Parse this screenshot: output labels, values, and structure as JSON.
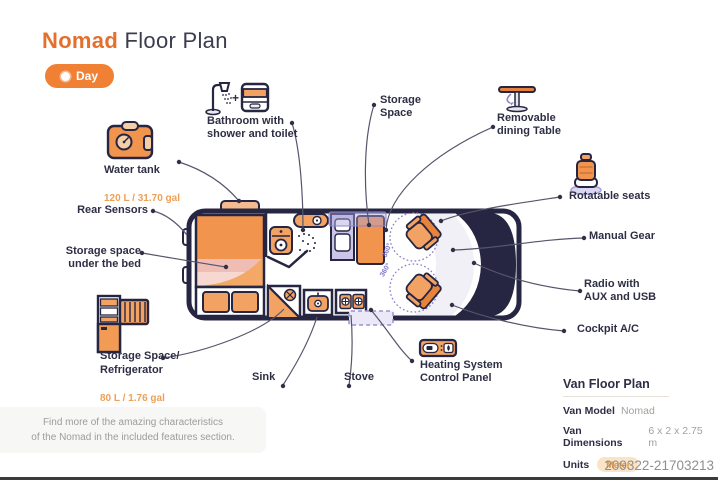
{
  "header": {
    "title_accent": "Nomad",
    "title_rest": "Floor Plan",
    "day_button": "Day"
  },
  "callouts": {
    "bathroom": {
      "label": "Bathroom with\nshower and toilet",
      "plus": "+"
    },
    "storage_space": {
      "label": "Storage\nSpace"
    },
    "dining_table": {
      "label": "Removable\ndining Table"
    },
    "water_tank": {
      "label": "Water tank",
      "value": "120 L / 31.70 gal"
    },
    "rear_sensors": {
      "label": "Rear Sensors"
    },
    "under_bed": {
      "label": "Storage space\nunder the bed"
    },
    "fridge": {
      "label": "Storage Space/\nRefrigerator",
      "value": "80 L / 1.76 gal"
    },
    "sink": {
      "label": "Sink"
    },
    "stove": {
      "label": "Stove"
    },
    "heating": {
      "label": "Heating System\nControl Panel"
    },
    "rotatable_seats": {
      "label": "Rotatable seats"
    },
    "manual_gear": {
      "label": "Manual Gear"
    },
    "radio": {
      "label": "Radio with\nAUX and USB"
    },
    "cockpit_ac": {
      "label": "Cockpit A/C"
    }
  },
  "van": {
    "rotation_label": "360°"
  },
  "note": {
    "line1": "Find more of the amazing characteristics",
    "line2": "of the Nomad in the included features section."
  },
  "info_panel": {
    "title": "Van Floor Plan",
    "rows": [
      {
        "label": "Van Model",
        "value": "Nomad"
      },
      {
        "label": "Van Dimensions",
        "value": "6 x 2 x 2.75 m"
      },
      {
        "label": "Units",
        "value": "Meter"
      }
    ]
  },
  "watermark": "209322-21703213",
  "colors": {
    "accent": "#E4702E",
    "navy": "#262642",
    "furniture": "#F0944E",
    "value_orange": "#EFA057",
    "purple": "#8C85CD"
  }
}
